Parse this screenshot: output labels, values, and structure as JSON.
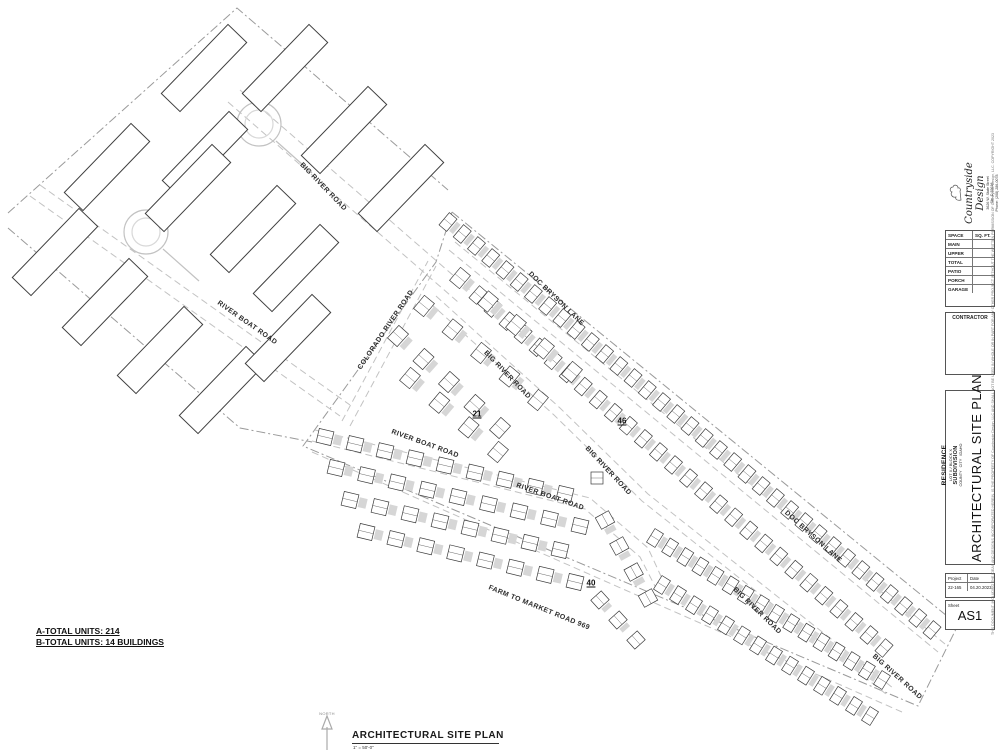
{
  "titleblock": {
    "logo": {
      "company": "Countryside Design",
      "address_line1": "3626 W. State Street",
      "address_line2": "Ste. D 83616",
      "address_line3": "Phone: (208) 286-0078"
    },
    "space_table": {
      "col1": "SPACE",
      "col2": "SQ. FT.",
      "rows": [
        "MAIN",
        "UPPER",
        "TOTAL",
        "PATIO",
        "PORCH",
        "GARAGE"
      ]
    },
    "contractor_label": "CONTRACTOR",
    "project_block": {
      "line1": "RESIDENCE",
      "line2": "LOT X / BLOCK X",
      "line3": "SUBDIVISION",
      "line4": "COUNTY   CITY   IDAHO"
    },
    "sheet_title": "ARCHITECTURAL SITE PLAN",
    "project_label": "Project",
    "date_label": "Date",
    "project_value": "22-165",
    "date_value": "04.20.2023",
    "sheet_label": "Sheet",
    "sheet_value": "AS1",
    "copyright": "THIS DOCUMENT, INCLUDING THE IDEAS AND DESIGNS INCORPORATED HEREIN, IS THE PROPERTY OF Countryside Design, LLC AND SHALL NOT BE USED IN WHOLE OR IN PART FOR ANY OTHER PROJECT WITHOUT THE WRITTEN PERMISSION OF Countryside Design, LLC.  COPYRIGHT 2023"
  },
  "notes": {
    "line1": "A-TOTAL UNITS: 214",
    "line2": "B-TOTAL UNITS: 14 BUILDINGS"
  },
  "view": {
    "north": "NORTH",
    "title": "ARCHITECTURAL SITE PLAN",
    "scale": "1\" = 50'-0\""
  },
  "plan": {
    "road_labels": [
      {
        "t": "BIG RIVER ROAD",
        "x": 323,
        "y": 187,
        "r": 46
      },
      {
        "t": "RIVER BOAT ROAD",
        "x": 247,
        "y": 323,
        "r": 35
      },
      {
        "t": "COLORADO RIVER ROAD",
        "x": 386,
        "y": 330,
        "r": -56
      },
      {
        "t": "DOC BRYSON LANE",
        "x": 556,
        "y": 299,
        "r": 44
      },
      {
        "t": "BIG RIVER ROAD",
        "x": 507,
        "y": 375,
        "r": 46
      },
      {
        "t": "BIG RIVER ROAD",
        "x": 608,
        "y": 471,
        "r": 47
      },
      {
        "t": "RIVER BOAT ROAD",
        "x": 425,
        "y": 444,
        "r": 20
      },
      {
        "t": "RIVER BOAT ROAD",
        "x": 550,
        "y": 497,
        "r": 19
      },
      {
        "t": "FARM TO MARKET ROAD 969",
        "x": 539,
        "y": 608,
        "r": 22
      },
      {
        "t": "DOC BRYSON LANE",
        "x": 813,
        "y": 537,
        "r": 42
      },
      {
        "t": "BIG RIVER ROAD",
        "x": 757,
        "y": 611,
        "r": 44
      },
      {
        "t": "BIG RIVER ROAD",
        "x": 897,
        "y": 677,
        "r": 42
      }
    ],
    "unit_counts": [
      {
        "t": "21",
        "x": 477,
        "y": 414
      },
      {
        "t": "46",
        "x": 622,
        "y": 421
      },
      {
        "t": "40",
        "x": 591,
        "y": 583
      }
    ],
    "big_buildings": [
      [
        204,
        68
      ],
      [
        285,
        68
      ],
      [
        344,
        130
      ],
      [
        401,
        188
      ],
      [
        107,
        167
      ],
      [
        205,
        155
      ],
      [
        188,
        188
      ],
      [
        253,
        229
      ],
      [
        296,
        268
      ],
      [
        55,
        252
      ],
      [
        105,
        302
      ],
      [
        160,
        350
      ],
      [
        222,
        390
      ],
      [
        288,
        338
      ]
    ],
    "unit_rows": [
      {
        "x1": 448,
        "y1": 222,
        "x2": 932,
        "y2": 630,
        "n": 35,
        "w": 10,
        "h": 16,
        "cw": 5
      },
      {
        "x1": 478,
        "y1": 295,
        "x2": 884,
        "y2": 648,
        "n": 28,
        "w": 10,
        "h": 16,
        "cw": 5
      },
      {
        "x1": 655,
        "y1": 538,
        "x2": 882,
        "y2": 680,
        "n": 16,
        "w": 10,
        "h": 16,
        "cw": 5
      },
      {
        "x1": 662,
        "y1": 585,
        "x2": 870,
        "y2": 716,
        "n": 14,
        "w": 10,
        "h": 16,
        "cw": 5
      },
      {
        "x1": 398,
        "y1": 336,
        "x2": 500,
        "y2": 428,
        "n": 5,
        "w": 13,
        "h": 17,
        "cw": 6
      },
      {
        "x1": 424,
        "y1": 306,
        "x2": 538,
        "y2": 400,
        "n": 5,
        "w": 13,
        "h": 17,
        "cw": 6
      },
      {
        "x1": 460,
        "y1": 278,
        "x2": 572,
        "y2": 372,
        "n": 5,
        "w": 13,
        "h": 17,
        "cw": 6
      },
      {
        "x1": 410,
        "y1": 378,
        "x2": 498,
        "y2": 452,
        "n": 4,
        "w": 13,
        "h": 17,
        "cw": 6
      },
      {
        "x1": 325,
        "y1": 437,
        "x2": 565,
        "y2": 494,
        "n": 9,
        "w": 15,
        "h": 14,
        "cw": 8
      },
      {
        "x1": 336,
        "y1": 468,
        "x2": 580,
        "y2": 526,
        "n": 9,
        "w": 15,
        "h": 14,
        "cw": 8
      },
      {
        "x1": 350,
        "y1": 500,
        "x2": 560,
        "y2": 550,
        "n": 8,
        "w": 15,
        "h": 14,
        "cw": 8
      },
      {
        "x1": 366,
        "y1": 532,
        "x2": 575,
        "y2": 582,
        "n": 8,
        "w": 15,
        "h": 14,
        "cw": 8
      },
      {
        "x1": 605,
        "y1": 520,
        "x2": 648,
        "y2": 598,
        "n": 4,
        "w": 13,
        "h": 15,
        "cw": 6
      },
      {
        "x1": 600,
        "y1": 600,
        "x2": 636,
        "y2": 640,
        "n": 3,
        "w": 12,
        "h": 14,
        "cw": 5
      },
      {
        "x1": 597,
        "y1": 478,
        "x2": 597,
        "y2": 478,
        "n": 1,
        "w": 12,
        "h": 12,
        "cw": 0
      }
    ]
  }
}
